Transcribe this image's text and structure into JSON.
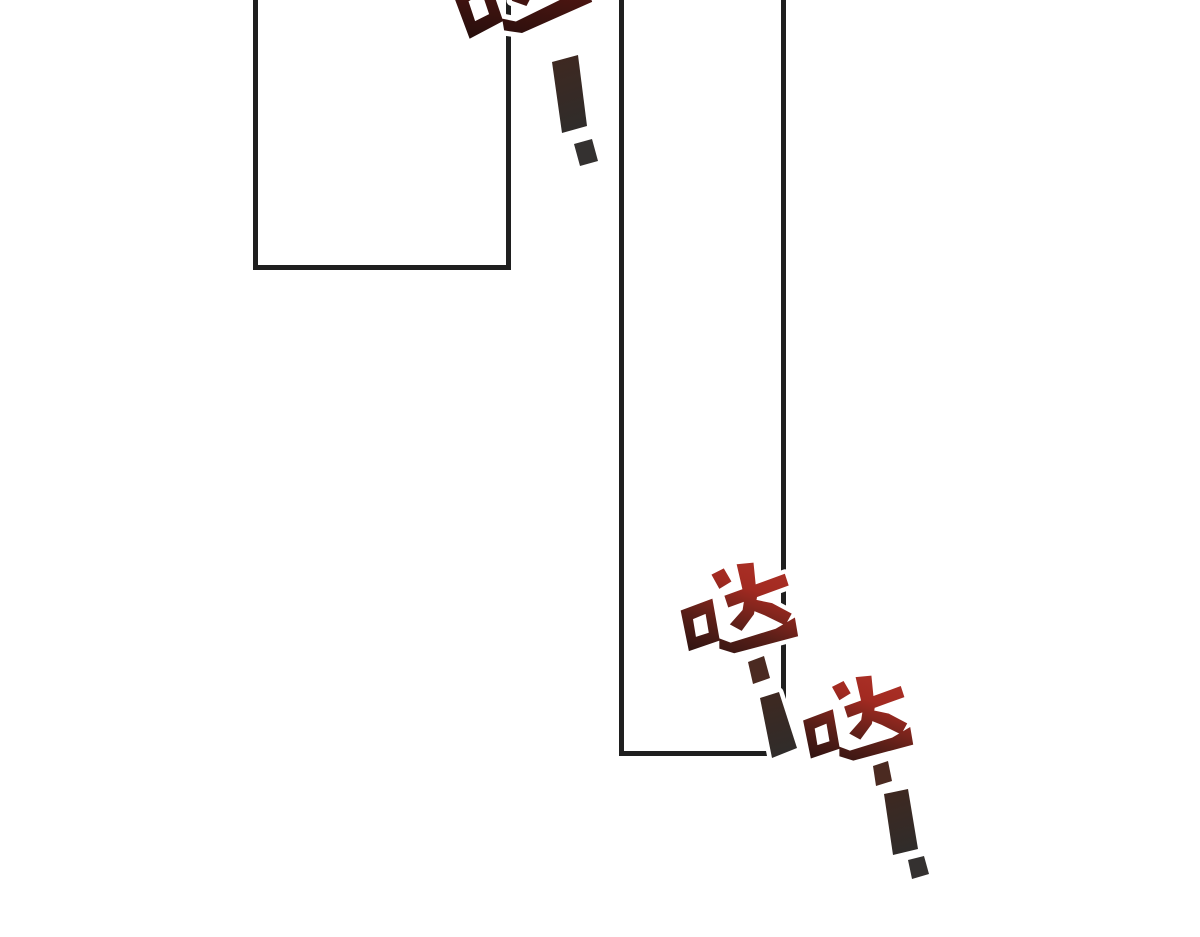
{
  "page": {
    "width": 1200,
    "height": 937,
    "background": "#ffffff",
    "kind_note": "comic page fragment with two empty panel frames and sound-effect lettering"
  },
  "colors": {
    "panel_border": "#1f1f1f",
    "halo": "#ffffff",
    "da_dark": "#241110",
    "da_mid": "#5a1f18",
    "da_bright": "#a22a21",
    "da_highlight": "#ab3026",
    "da_top_dark": "#1f0d0b",
    "da_top_mid": "#4a1511",
    "da_top_bright": "#7c1a14",
    "excl_top": "#3f2820",
    "excl_bottom": "#302c2a",
    "dot": "#343130",
    "dash": "#4b2a21"
  },
  "sfx": {
    "items": [
      {
        "text": "哒"
      },
      {
        "text": "！"
      },
      {
        "text": "哒"
      },
      {
        "text": "！"
      },
      {
        "text": "哒"
      },
      {
        "text": "！"
      }
    ]
  }
}
